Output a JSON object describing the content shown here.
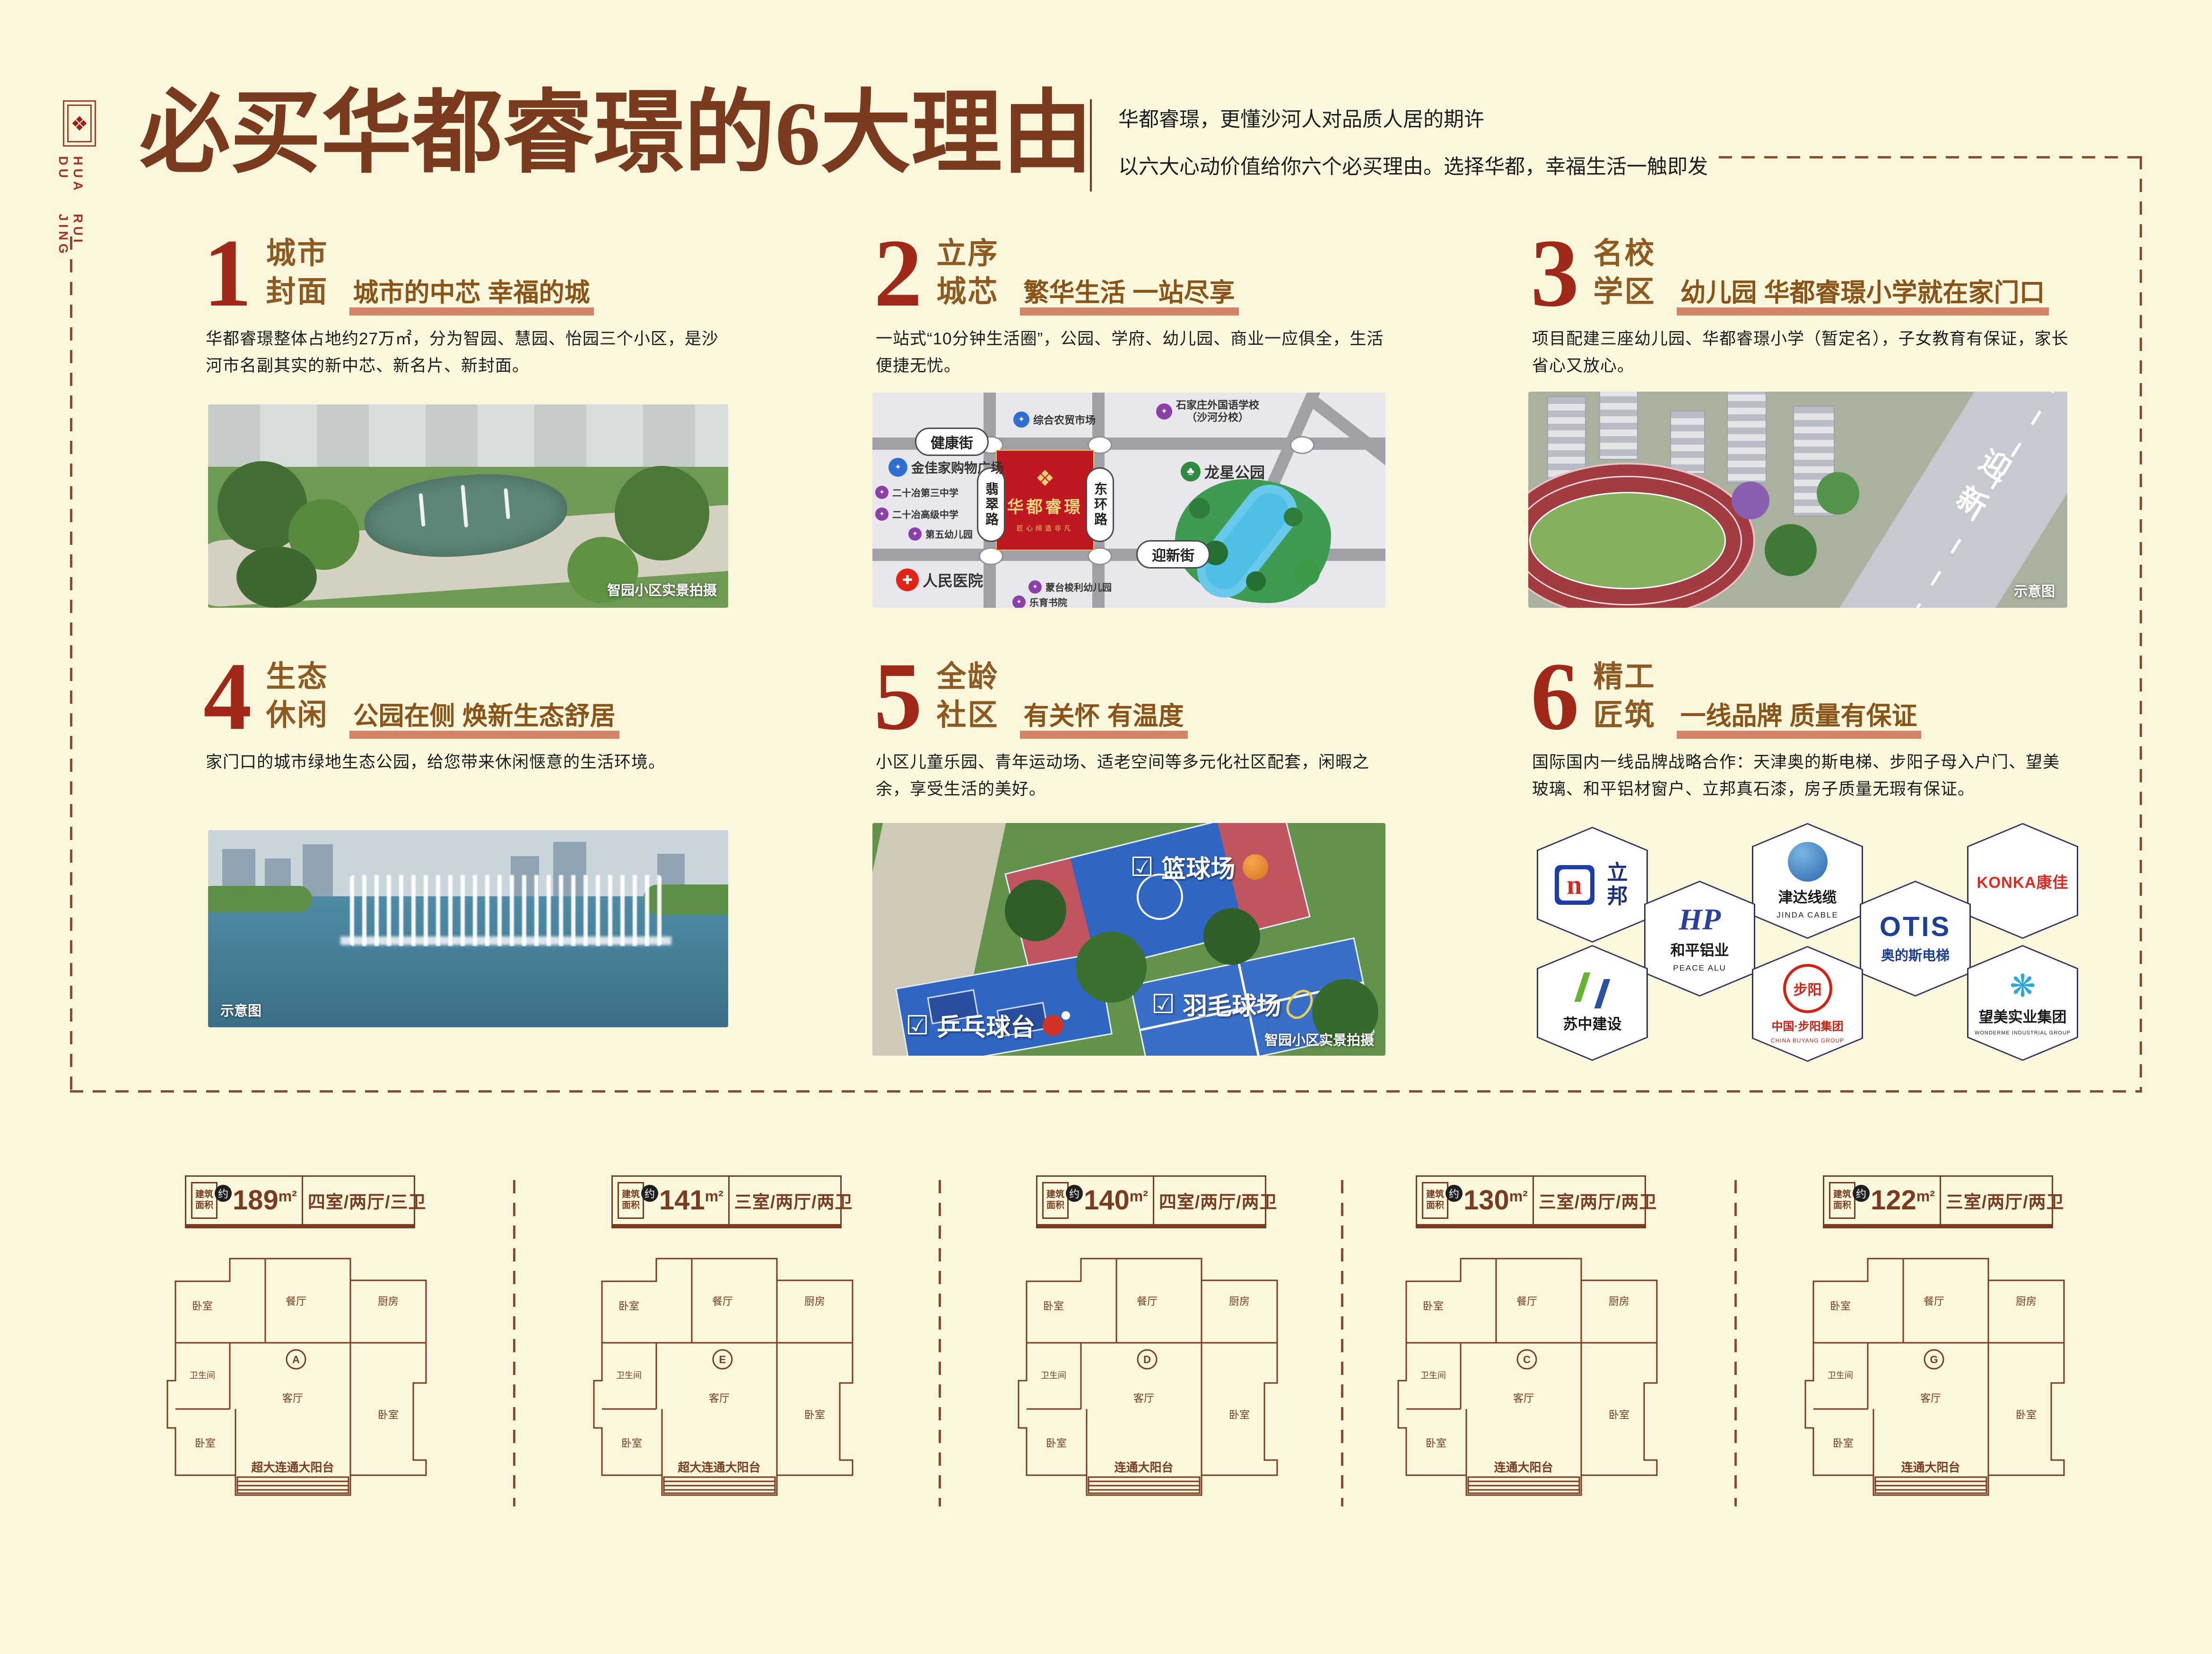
{
  "page": {
    "bg": "#FBF7DC",
    "accent_red": "#A02818",
    "accent_brown": "#7A3A1D",
    "underline_salmon": "#D28368"
  },
  "logo": {
    "seal_glyph": "❖",
    "line1": "HUA DU",
    "line2": "RUI JING"
  },
  "header": {
    "title": "必买华都睿璟的6大理由",
    "tagline1": "华都睿璟，更懂沙河人对品质人居的期许",
    "tagline2": "以六大心动价值给你六个必买理由。选择华都，幸福生活一触即发"
  },
  "sections": [
    {
      "num": "1",
      "title1": "城市",
      "title2": "封面",
      "subtitle": "城市的中芯 幸福的城",
      "body": "华都睿璟整体占地约27万㎡，分为智园、慧园、怡园三个小区，是沙河市名副其实的新中芯、新名片、新封面。",
      "caption": "智园小区实景拍摄"
    },
    {
      "num": "2",
      "title1": "立序",
      "title2": "城芯",
      "subtitle": "繁华生活 一站尽享",
      "body": "一站式“10分钟生活圈”，公园、学府、幼儿园、商业一应俱全，生活便捷无忧。"
    },
    {
      "num": "3",
      "title1": "名校",
      "title2": "学区",
      "subtitle": "幼儿园 华都睿璟小学就在家门口",
      "body": "项目配建三座幼儿园、华都睿璟小学（暂定名），子女教育有保证，家长省心又放心。",
      "caption": "示意图",
      "road_label": "迎新"
    },
    {
      "num": "4",
      "title1": "生态",
      "title2": "休闲",
      "subtitle": "公园在侧 焕新生态舒居",
      "body": "家门口的城市绿地生态公园，给您带来休闲惬意的生活环境。",
      "caption": "示意图"
    },
    {
      "num": "5",
      "title1": "全龄",
      "title2": "社区",
      "subtitle": "有关怀 有温度",
      "body": "小区儿童乐园、青年运动场、适老空间等多元化社区配套，闲暇之余，享受生活的美好。",
      "caption": "智园小区实景拍摄",
      "check": "☑",
      "tag1": "篮球场",
      "tag2": "羽毛球场",
      "tag3": "乒乓球台"
    },
    {
      "num": "6",
      "title1": "精工",
      "title2": "匠筑",
      "subtitle": "一线品牌 质量有保证",
      "body": "国际国内一线品牌战略合作：天津奥的斯电梯、步阳子母入户门、望美玻璃、和平铝材窗户、立邦真石漆，房子质量无瑕有保证。"
    }
  ],
  "map": {
    "project": "华都睿璟",
    "slogan": "匠心缔造非凡",
    "ornament": "❖",
    "road_jiankang": "健康街",
    "road_feicui": "翡翠路",
    "road_donghuan": "东环路",
    "road_yingxin": "迎新街",
    "poi_market": "综合农贸市场",
    "poi_foreign_school": "石家庄外国语学校",
    "poi_foreign_school2": "（沙河分校）",
    "poi_mall": "金佳家购物广场",
    "poi_school3": "二十冶第三中学",
    "poi_school_senior": "二十冶高级中学",
    "poi_kg5": "第五幼儿园",
    "poi_hospital": "人民医院",
    "poi_montessori": "蒙台梭利幼儿园",
    "poi_academy": "乐育书院",
    "poi_park": "龙星公园"
  },
  "icons": {
    "market": "✦",
    "school": "✦",
    "hospital": "✚",
    "park": "♣"
  },
  "brands": {
    "b1_mark": "n",
    "b1_name": "立邦",
    "b2_mark": "HP",
    "b2_name": "和平铝业",
    "b2_sub": "PEACE ALU",
    "b3_name": "津达线缆",
    "b3_sub": "JINDA CABLE",
    "b4_mark": "OTIS",
    "b4_name": "奥的斯电梯",
    "b5_name": "KONKA康佳",
    "b6_name": "苏中建设",
    "b7_mark": "步阳",
    "b7_name": "中国·步阳集团",
    "b7_sub": "CHINA BUYANG GROUP",
    "b8_mark": "❋",
    "b8_name": "望美实业集团",
    "b8_sub": "WONDERME INDUSTRIAL GROUP"
  },
  "plan_shared": {
    "area_label1": "建筑",
    "area_label2": "面积",
    "approx": "约",
    "room_bed": "卧室",
    "room_living": "客厅",
    "room_dining": "餐厅",
    "room_kitchen": "厨房",
    "room_bath": "卫生间"
  },
  "plans": [
    {
      "area": "189",
      "unit": "m²",
      "config": "四室/两厅/三卫",
      "balcony": "超大连通大阳台",
      "letter": "A"
    },
    {
      "area": "141",
      "unit": "m²",
      "config": "三室/两厅/两卫",
      "balcony": "超大连通大阳台",
      "letter": "E"
    },
    {
      "area": "140",
      "unit": "m²",
      "config": "四室/两厅/两卫",
      "balcony": "连通大阳台",
      "letter": "D"
    },
    {
      "area": "130",
      "unit": "m²",
      "config": "三室/两厅/两卫",
      "balcony": "连通大阳台",
      "letter": "C"
    },
    {
      "area": "122",
      "unit": "m²",
      "config": "三室/两厅/两卫",
      "balcony": "连通大阳台",
      "letter": "G"
    }
  ]
}
